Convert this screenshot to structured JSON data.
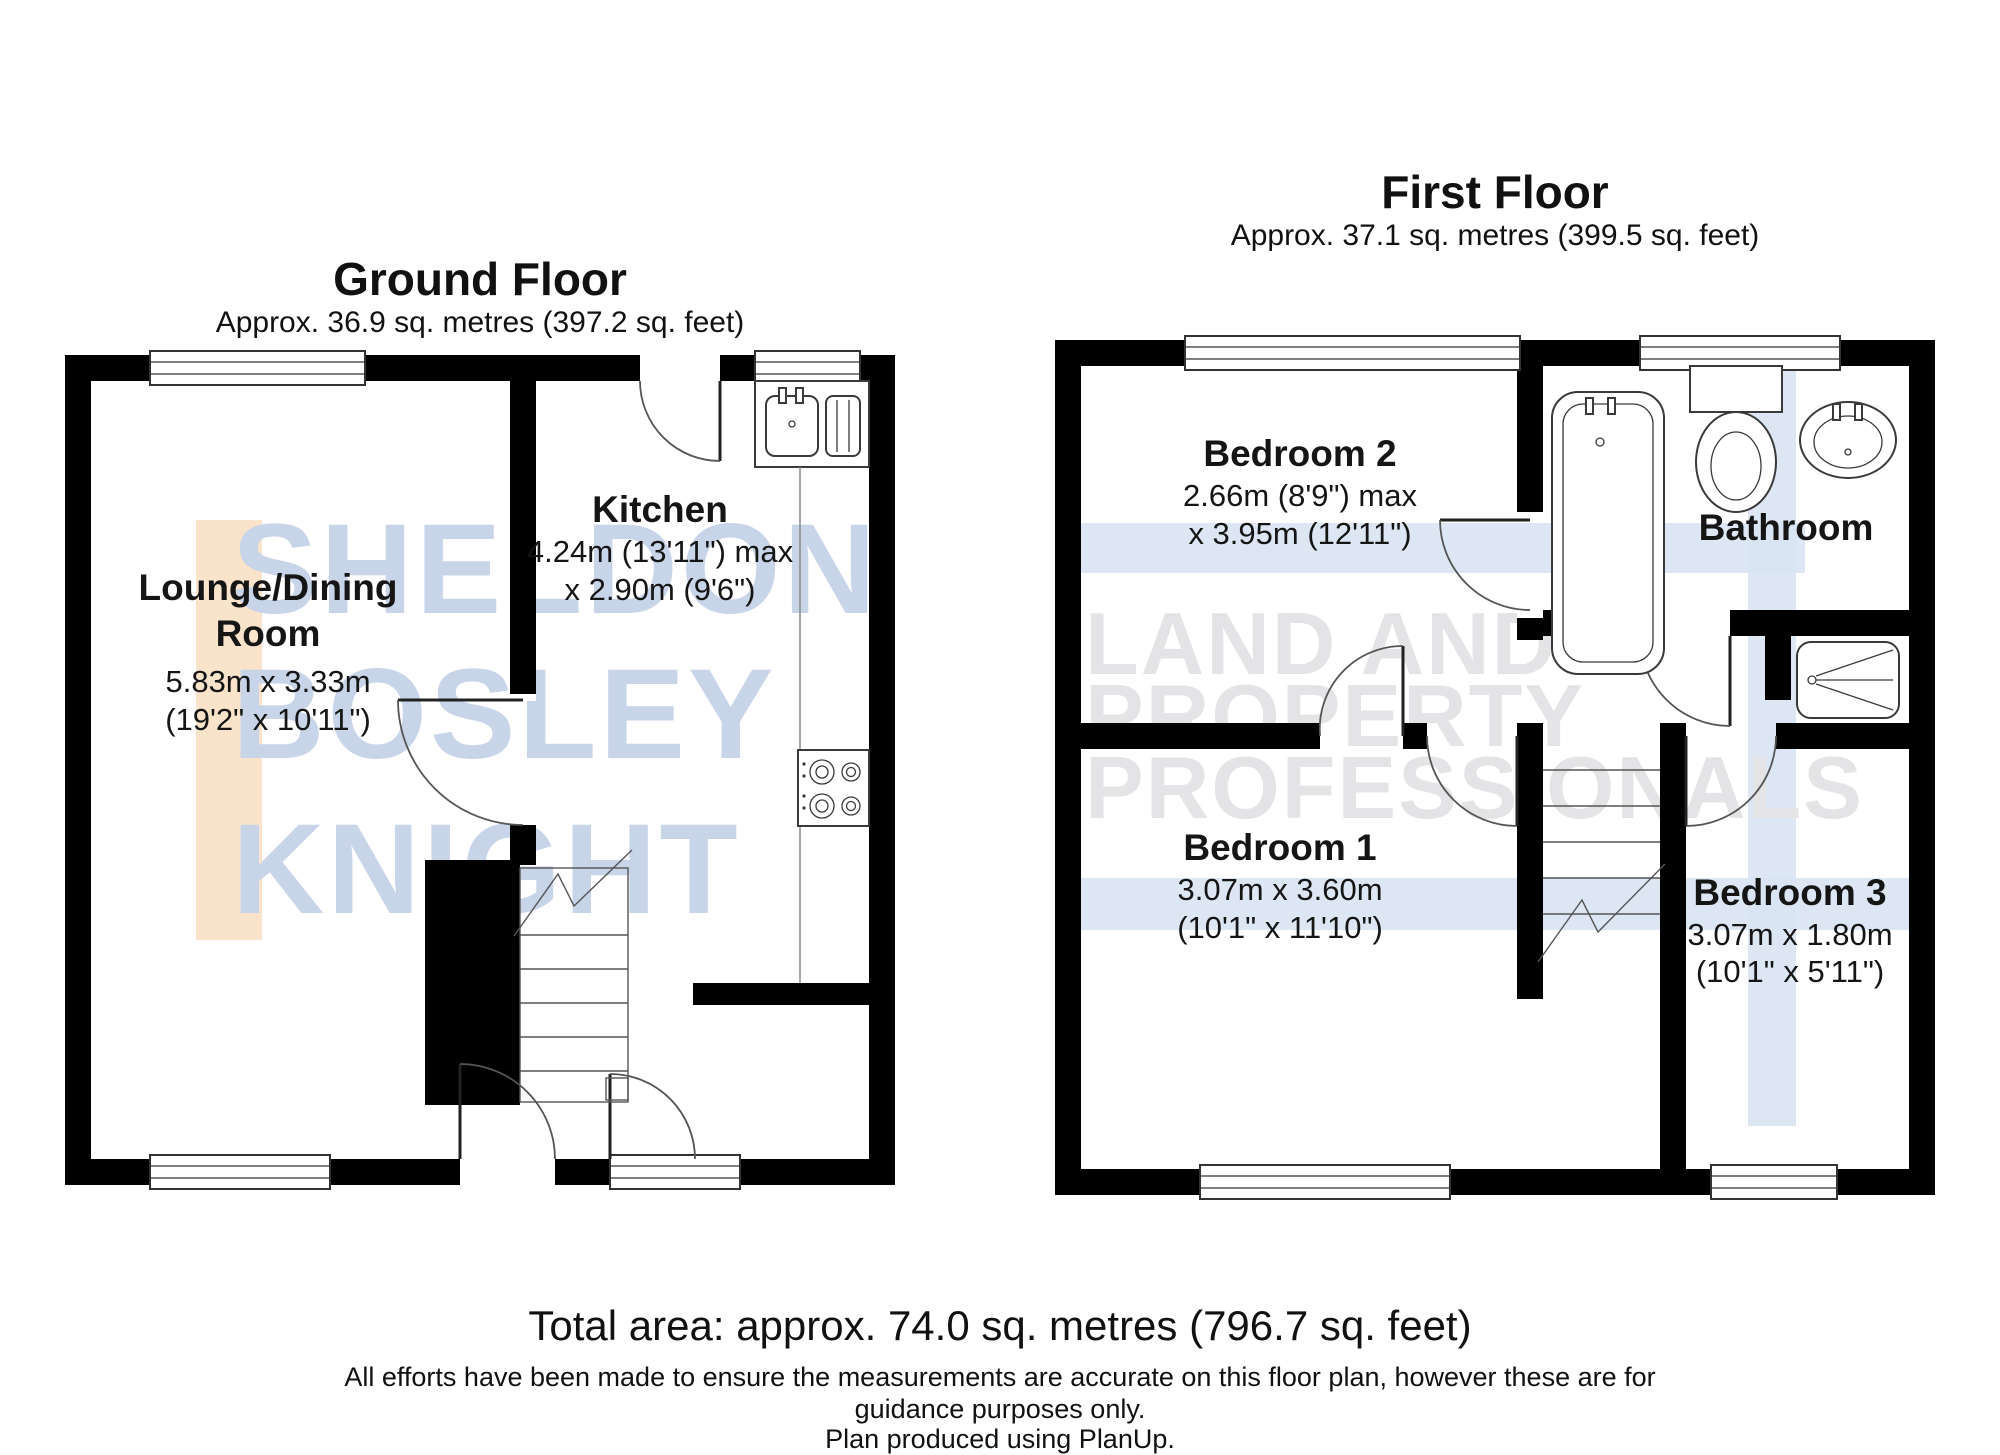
{
  "ground_floor": {
    "title": "Ground Floor",
    "area": "Approx. 36.9 sq. metres (397.2 sq. feet)",
    "rooms": {
      "lounge": {
        "name_line1": "Lounge/Dining",
        "name_line2": "Room",
        "dim_metric": "5.83m x 3.33m",
        "dim_imperial": "(19'2\" x 10'11\")"
      },
      "kitchen": {
        "name": "Kitchen",
        "dim_line1": "4.24m (13'11\") max",
        "dim_line2": "x 2.90m (9'6\")"
      }
    }
  },
  "first_floor": {
    "title": "First Floor",
    "area": "Approx. 37.1 sq. metres (399.5 sq. feet)",
    "rooms": {
      "bedroom2": {
        "name": "Bedroom 2",
        "dim_line1": "2.66m (8'9\") max",
        "dim_line2": "x 3.95m (12'11\")"
      },
      "bathroom": {
        "name": "Bathroom"
      },
      "bedroom1": {
        "name": "Bedroom 1",
        "dim_line1": "3.07m x 3.60m",
        "dim_line2": "(10'1\" x 11'10\")"
      },
      "bedroom3": {
        "name": "Bedroom 3",
        "dim_line1": "3.07m x 1.80m",
        "dim_line2": "(10'1\" x 5'11\")"
      }
    }
  },
  "footer": {
    "total_area": "Total area: approx. 74.0 sq. metres (796.7 sq. feet)",
    "disclaimer_line1": "All efforts have been made to ensure the measurements are accurate on this floor plan, however these are for",
    "disclaimer_line2": "guidance purposes only.",
    "disclaimer_line3": "Plan produced using PlanUp."
  },
  "watermark": {
    "left_line1": "SHELDON",
    "left_line2": "BOSLEY",
    "left_line3": "KNIGHT",
    "right_line1": "LAND AND",
    "right_line2": "PROPERTY",
    "right_line3": "PROFESSIONALS",
    "brand_blue": "#c8d4e8",
    "brand_gray": "#e4e4e6",
    "brand_peach": "#fae3cb",
    "band_blue": "#d9e4f3"
  }
}
